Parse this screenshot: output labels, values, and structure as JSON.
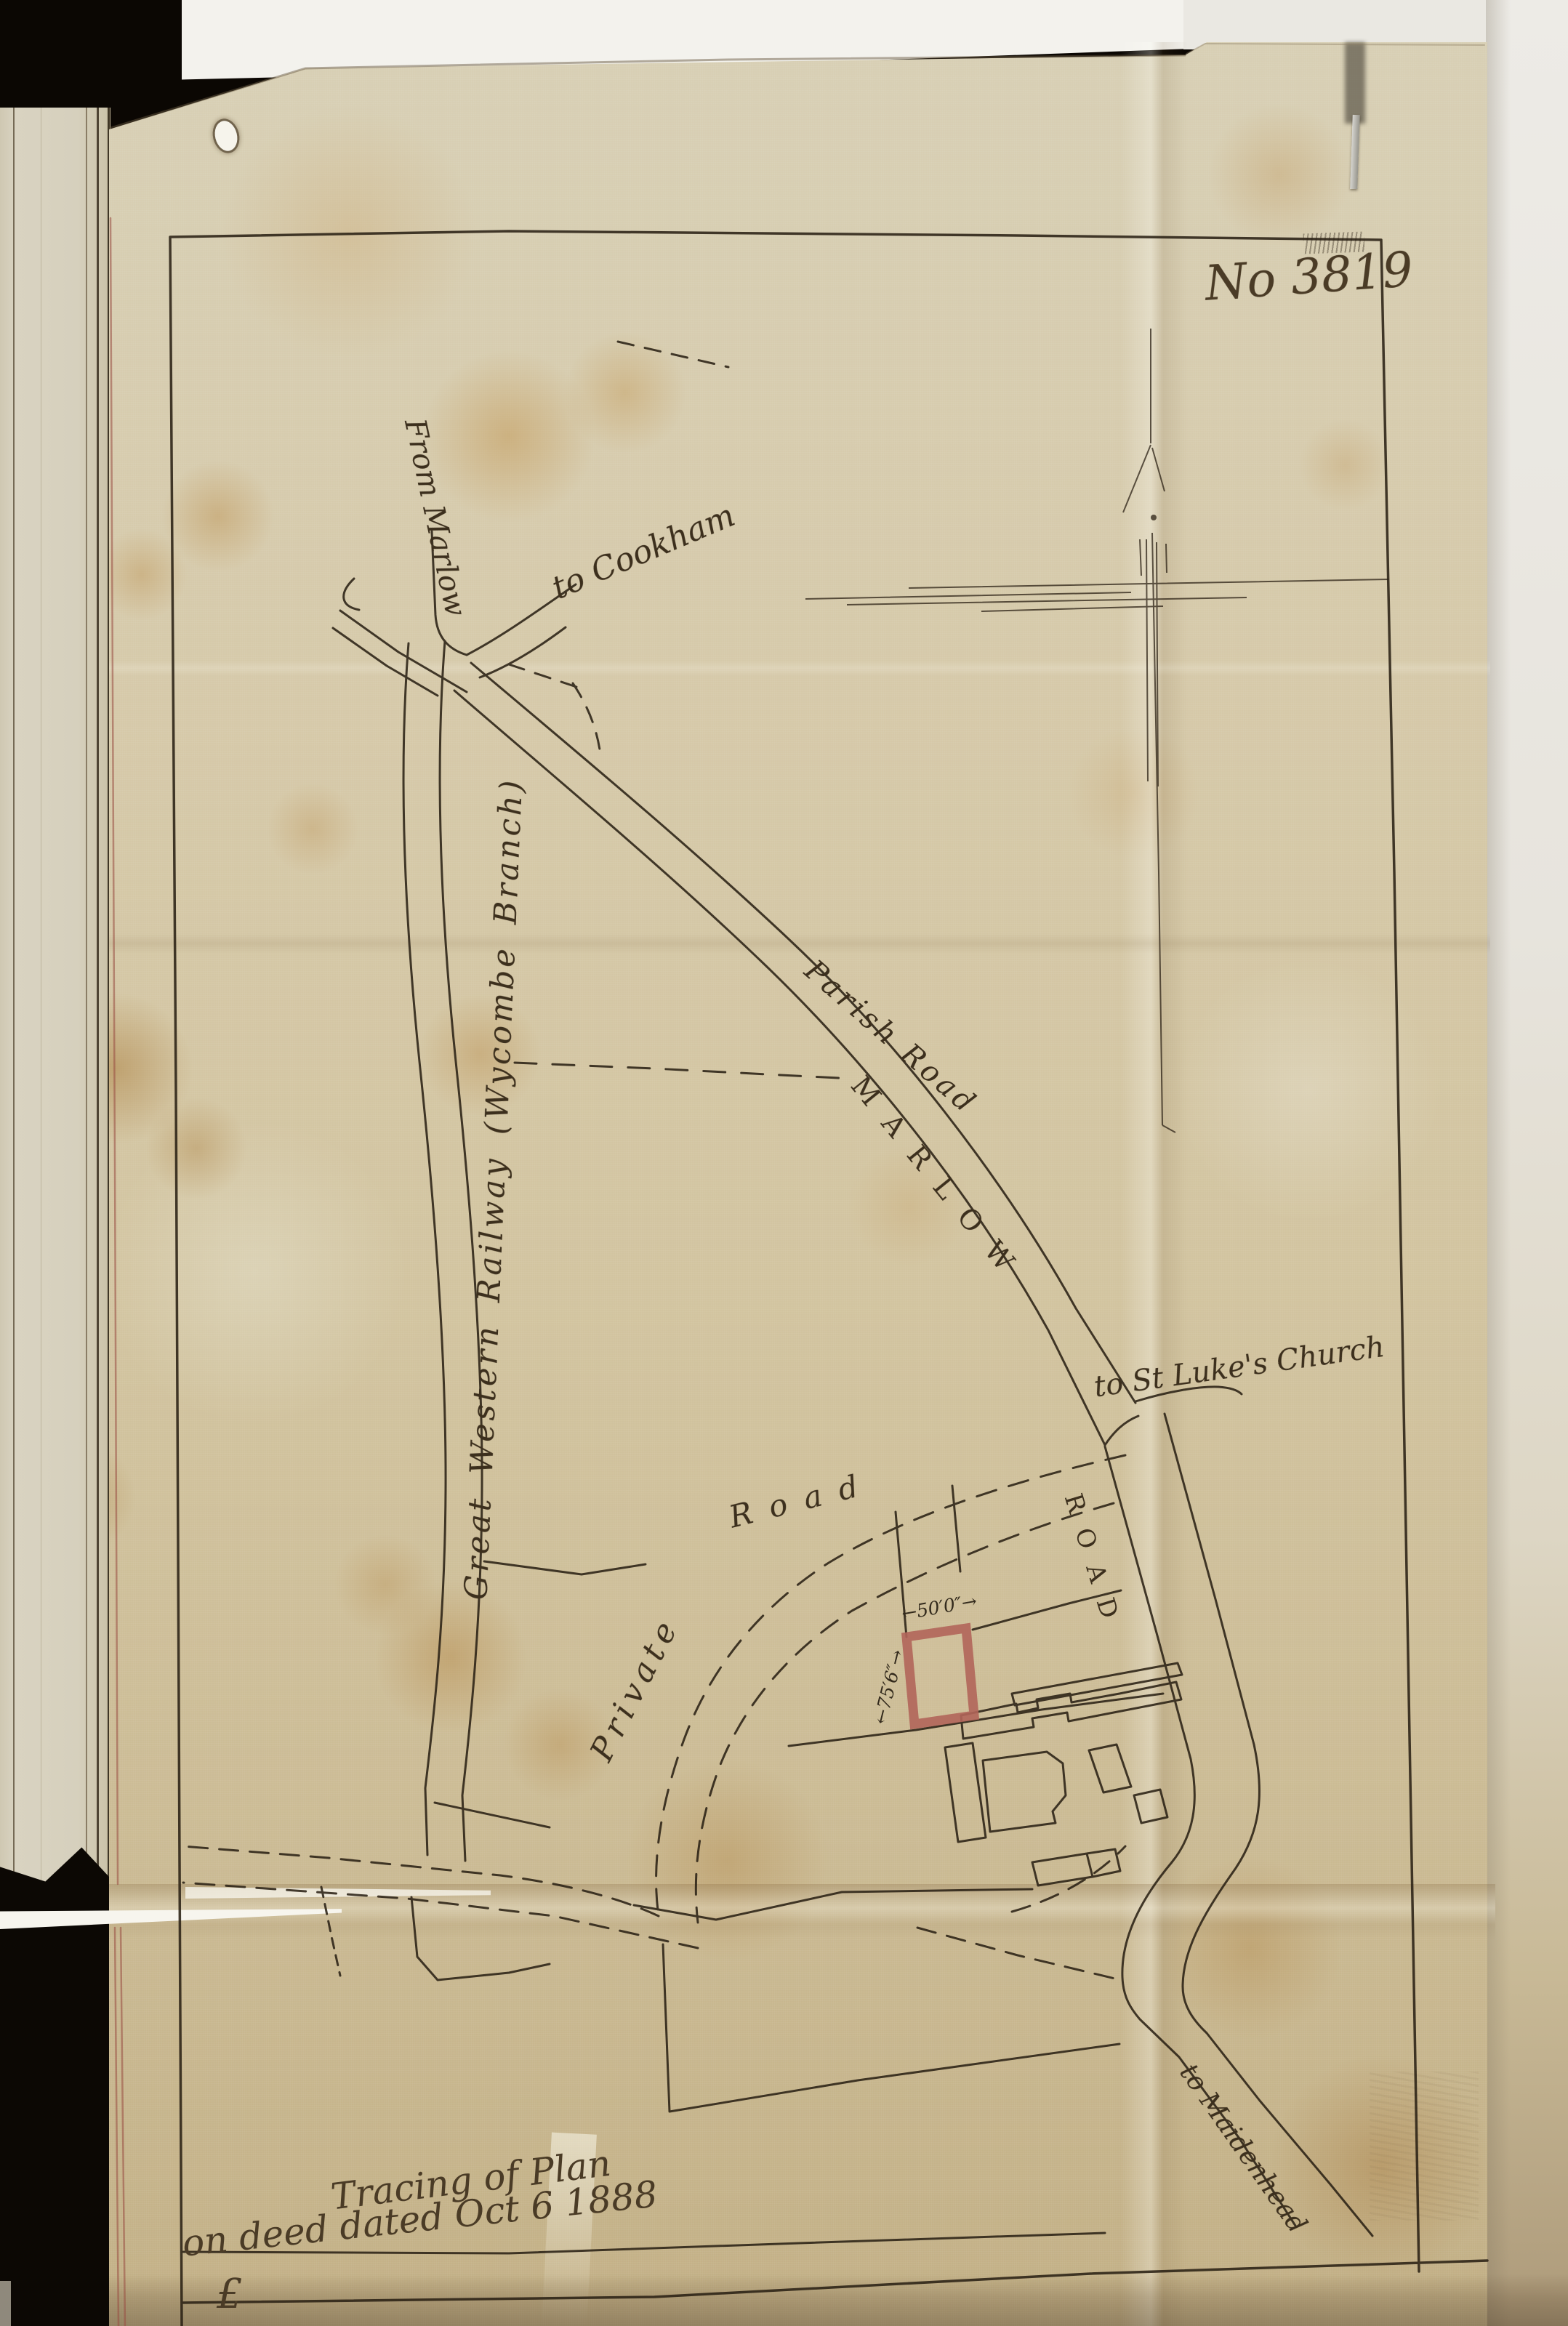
{
  "page": {
    "plan_number": "No 3819",
    "docket_line1": "Tracing of Plan",
    "docket_line2": "on deed dated Oct 6 1888",
    "docket_flourish": "£"
  },
  "map": {
    "labels": {
      "from_marlow": "From Marlow",
      "to_cookham": "to Cookham",
      "railway": "Great Western Railway (Wycombe Branch)",
      "parish_road": "Parish Road",
      "marlow_caps": "MARLOW",
      "road_caps": "ROAD",
      "to_st_lukes": "to St Luke's Church",
      "private_word": "Private",
      "road_word": "Road",
      "to_maidenhead": "to Maidenhead"
    },
    "plot_dimensions": {
      "frontage": "←50′0″→",
      "depth": "←75′6″→"
    },
    "colors": {
      "ink": "#2b2115",
      "plot_highlight": "#b2655a",
      "cloth": "#d2c4a0"
    }
  }
}
